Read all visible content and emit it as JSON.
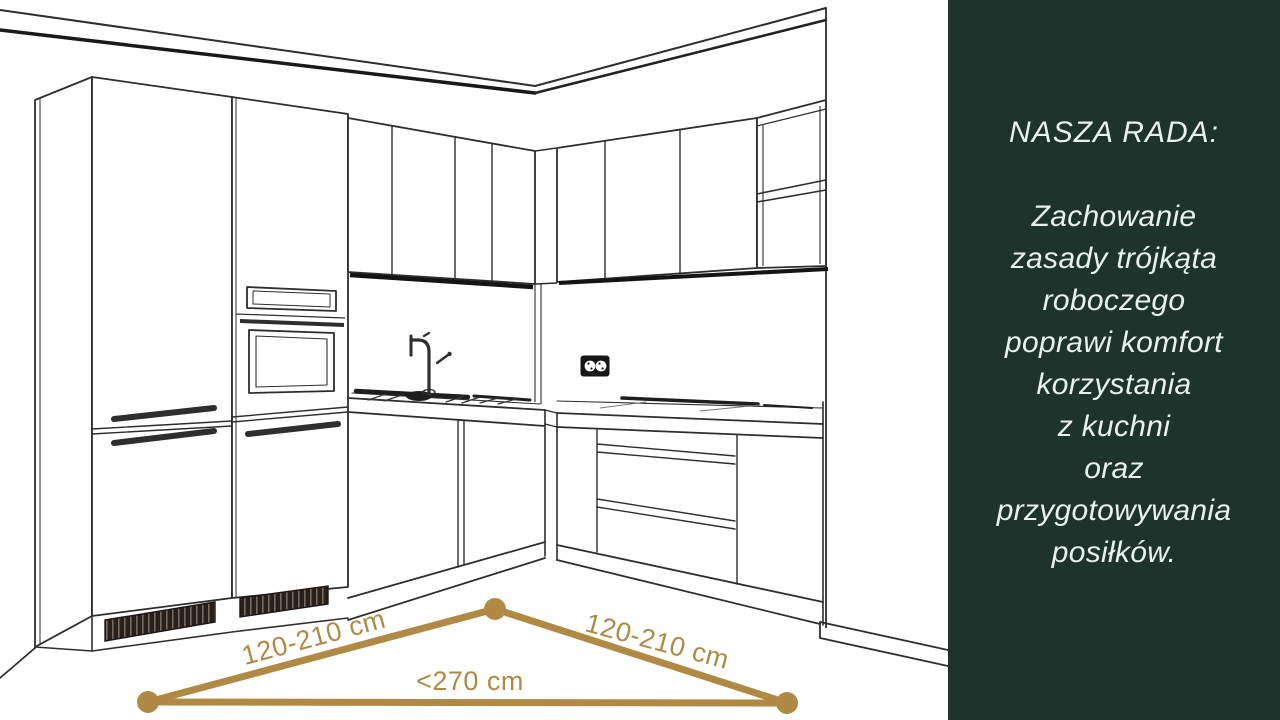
{
  "advice_panel": {
    "title": "NASZA RADA:",
    "lines": [
      "Zachowanie",
      "zasady trójkąta",
      "roboczego",
      "poprawi komfort",
      "korzystania",
      "z kuchni",
      "oraz",
      "przygotowywania",
      "posiłków."
    ],
    "background_color": "#1d332b",
    "text_color": "#e9f1ec"
  },
  "work_triangle": {
    "left_label": "120-210 cm",
    "right_label": "120-210 cm",
    "base_label": "<270 cm",
    "color": "#b08a44"
  }
}
